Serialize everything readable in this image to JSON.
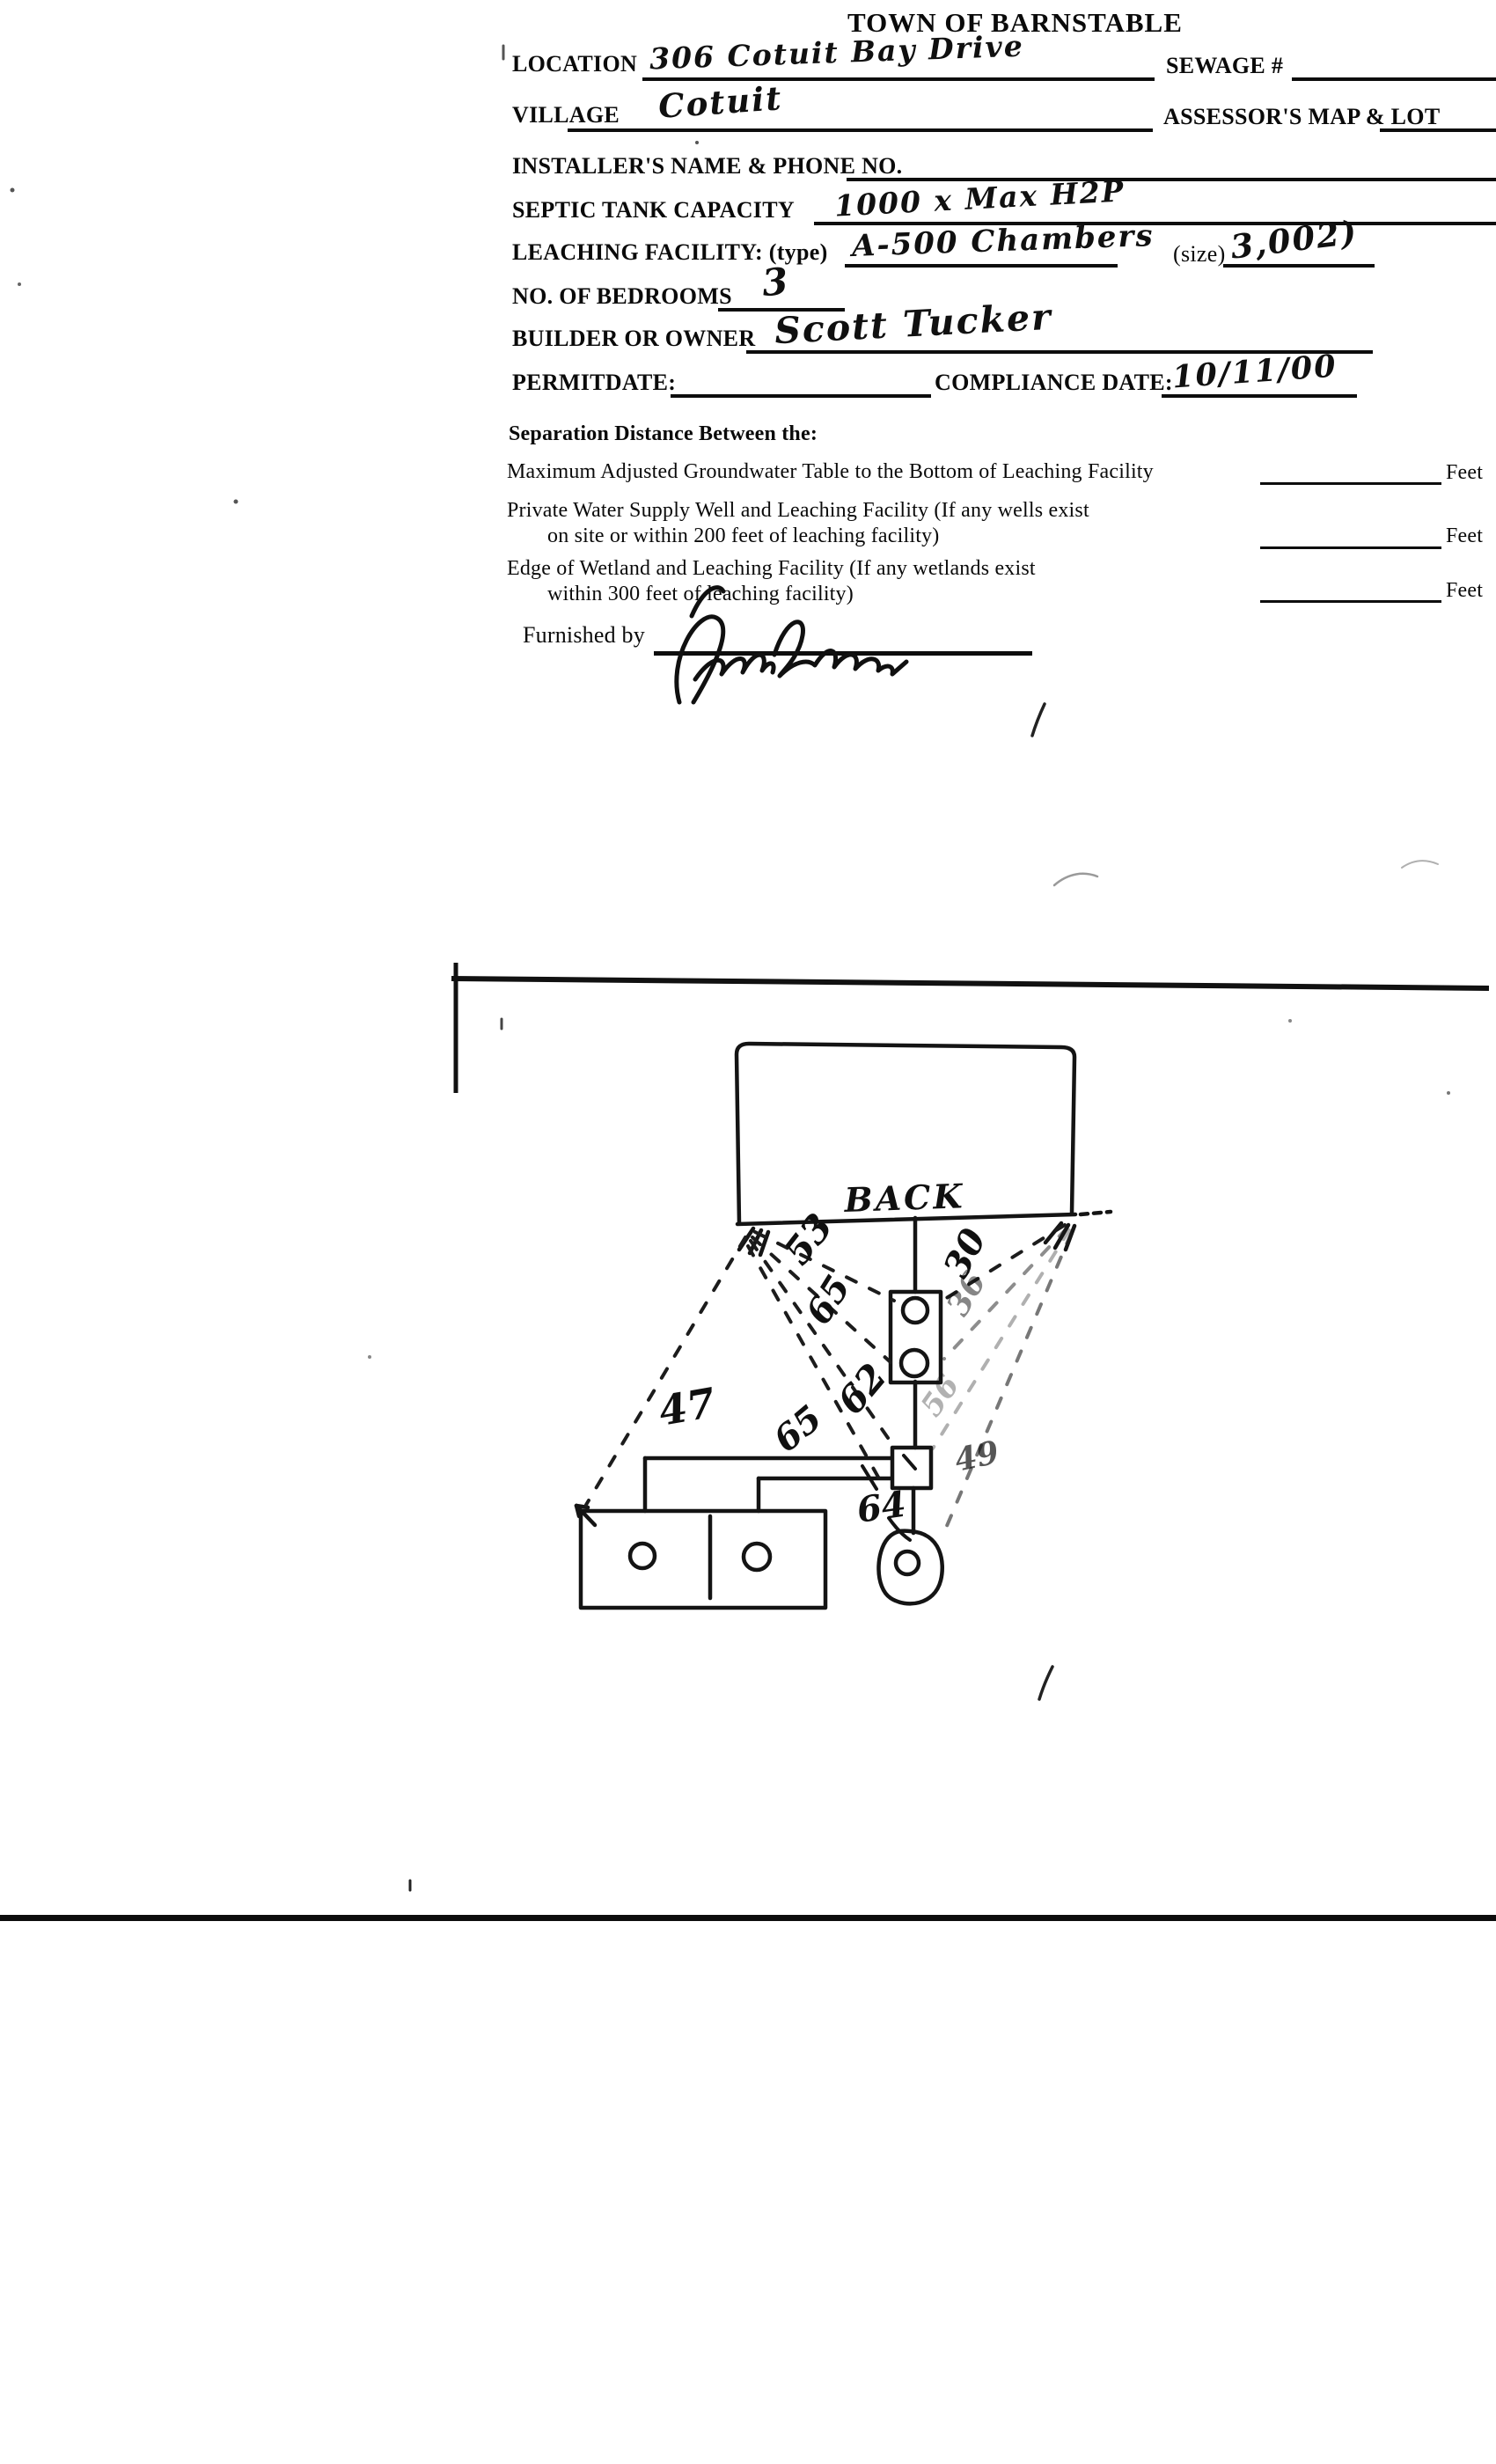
{
  "document": {
    "title": "TOWN OF BARNSTABLE",
    "fields": {
      "location_label": "LOCATION",
      "location_value": "306 Cotuit Bay Drive",
      "sewage_label": "SEWAGE #",
      "sewage_value": "",
      "village_label": "VILLAGE",
      "village_value": "Cotuit",
      "assessors_label": "ASSESSOR'S MAP & LOT",
      "assessors_value": "",
      "installer_label": "INSTALLER'S NAME & PHONE NO.",
      "installer_value": "",
      "septic_label": "SEPTIC TANK CAPACITY",
      "septic_value": "1000 x Max H2P",
      "leaching_label": "LEACHING FACILITY: (type)",
      "leaching_type_value": "A-500 Chambers",
      "size_label": "(size)",
      "size_value": "3,002)",
      "bedrooms_label": "NO. OF BEDROOMS",
      "bedrooms_value": "3",
      "builder_label": "BUILDER OR OWNER",
      "builder_value": "Scott Tucker",
      "permit_label": "PERMITDATE:",
      "permit_value": "",
      "compliance_label": "COMPLIANCE DATE:",
      "compliance_value": "10/11/00"
    },
    "separation": {
      "heading": "Separation Distance Between the:",
      "row1_line1": "Maximum Adjusted Groundwater Table to the Bottom of Leaching Facility",
      "row2_line1": "Private Water Supply Well and Leaching Facility  (If any wells exist",
      "row2_line2": "on site or within 200 feet of leaching facility)",
      "row3_line1": "Edge of Wetland and Leaching Facility (If any wetlands exist",
      "row3_line2": "within 300 feet of leaching facility)",
      "unit": "Feet",
      "furnished_label": "Furnished by",
      "furnished_signature": "(illegible signature)"
    },
    "sketch": {
      "house_label": "BACK",
      "measurements": [
        "53",
        "65",
        "30",
        "36",
        "47",
        "62",
        "65",
        "56",
        "49",
        "64"
      ]
    }
  }
}
